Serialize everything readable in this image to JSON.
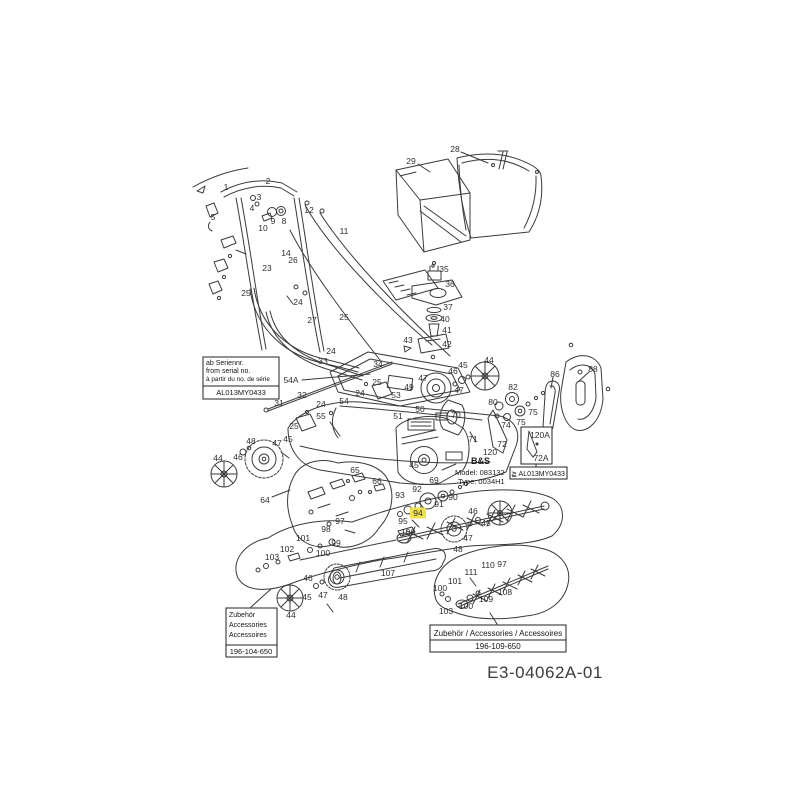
{
  "colors": {
    "background": "#ffffff",
    "line": "#3a3a3a",
    "highlight": "#efe24e",
    "label_text": "#2e2e2e"
  },
  "doc_code": "E3-04062A-01",
  "engine_plate": {
    "brand": "B&S",
    "model": "Model: 083132",
    "type": "Type: 0034H1"
  },
  "boxes": {
    "serial": {
      "line1": "ab Seriennr.",
      "line2": "from serial no.",
      "line3": "à partir du no. de série",
      "code": "AL013MY0433"
    },
    "variant": {
      "code": "≧ AL013MY0433"
    },
    "accessories_left": {
      "line1": "Zubehör",
      "line2": "Accessories",
      "line3": "Accessoires",
      "code": "196-104-650"
    },
    "accessories_right": {
      "title": "Zubehör / Accessories / Accessoires",
      "code": "196-109-650"
    }
  },
  "diagram": {
    "labels": [
      {
        "t": "1",
        "x": 226,
        "y": 187
      },
      {
        "t": "2",
        "x": 268,
        "y": 181
      },
      {
        "t": "3",
        "x": 259,
        "y": 197
      },
      {
        "t": "4",
        "x": 252,
        "y": 208
      },
      {
        "t": "5",
        "x": 213,
        "y": 217
      },
      {
        "t": "9",
        "x": 273,
        "y": 221
      },
      {
        "t": "8",
        "x": 284,
        "y": 221
      },
      {
        "t": "10",
        "x": 263,
        "y": 228
      },
      {
        "t": "12",
        "x": 309,
        "y": 210
      },
      {
        "t": "11",
        "x": 344,
        "y": 231
      },
      {
        "t": "14",
        "x": 286,
        "y": 253
      },
      {
        "t": "26",
        "x": 293,
        "y": 260
      },
      {
        "t": "23",
        "x": 267,
        "y": 268
      },
      {
        "t": "25",
        "x": 246,
        "y": 293
      },
      {
        "t": "24",
        "x": 298,
        "y": 302
      },
      {
        "t": "27",
        "x": 312,
        "y": 320
      },
      {
        "t": "25",
        "x": 344,
        "y": 317
      },
      {
        "t": "29",
        "x": 411,
        "y": 161
      },
      {
        "t": "28",
        "x": 455,
        "y": 149
      },
      {
        "t": "35",
        "x": 444,
        "y": 269
      },
      {
        "t": "36",
        "x": 450,
        "y": 284
      },
      {
        "t": "37",
        "x": 448,
        "y": 307
      },
      {
        "t": "40",
        "x": 445,
        "y": 319
      },
      {
        "t": "41",
        "x": 447,
        "y": 330
      },
      {
        "t": "42",
        "x": 447,
        "y": 344
      },
      {
        "t": "43",
        "x": 408,
        "y": 340
      },
      {
        "t": "24",
        "x": 331,
        "y": 351
      },
      {
        "t": "33",
        "x": 323,
        "y": 361
      },
      {
        "t": "34",
        "x": 378,
        "y": 364
      },
      {
        "t": "54A",
        "x": 291,
        "y": 380
      },
      {
        "t": "25",
        "x": 377,
        "y": 382
      },
      {
        "t": "32",
        "x": 302,
        "y": 395
      },
      {
        "t": "24",
        "x": 360,
        "y": 393
      },
      {
        "t": "54",
        "x": 344,
        "y": 401
      },
      {
        "t": "31",
        "x": 279,
        "y": 403
      },
      {
        "t": "24",
        "x": 321,
        "y": 404
      },
      {
        "t": "55",
        "x": 321,
        "y": 416
      },
      {
        "t": "25",
        "x": 294,
        "y": 426
      },
      {
        "t": "48",
        "x": 251,
        "y": 441
      },
      {
        "t": "45",
        "x": 288,
        "y": 439
      },
      {
        "t": "47",
        "x": 277,
        "y": 443
      },
      {
        "t": "46",
        "x": 238,
        "y": 457
      },
      {
        "t": "44",
        "x": 218,
        "y": 458
      },
      {
        "t": "44",
        "x": 489,
        "y": 360
      },
      {
        "t": "45",
        "x": 463,
        "y": 365
      },
      {
        "t": "46",
        "x": 453,
        "y": 371
      },
      {
        "t": "47",
        "x": 423,
        "y": 378
      },
      {
        "t": "47",
        "x": 459,
        "y": 390
      },
      {
        "t": "49",
        "x": 409,
        "y": 387
      },
      {
        "t": "53",
        "x": 396,
        "y": 395
      },
      {
        "t": "50",
        "x": 420,
        "y": 409
      },
      {
        "t": "51",
        "x": 398,
        "y": 416
      },
      {
        "t": "86",
        "x": 555,
        "y": 374
      },
      {
        "t": "88",
        "x": 593,
        "y": 369
      },
      {
        "t": "82",
        "x": 513,
        "y": 387
      },
      {
        "t": "80",
        "x": 493,
        "y": 402
      },
      {
        "t": "75",
        "x": 533,
        "y": 412
      },
      {
        "t": "75",
        "x": 521,
        "y": 422
      },
      {
        "t": "74",
        "x": 506,
        "y": 425
      },
      {
        "t": "70",
        "x": 456,
        "y": 415
      },
      {
        "t": "71",
        "x": 473,
        "y": 439
      },
      {
        "t": "72",
        "x": 502,
        "y": 444
      },
      {
        "t": "120",
        "x": 490,
        "y": 452
      },
      {
        "t": "120A",
        "x": 540,
        "y": 435
      },
      {
        "t": "72A",
        "x": 541,
        "y": 458
      },
      {
        "t": "45",
        "x": 414,
        "y": 465
      },
      {
        "t": "69",
        "x": 434,
        "y": 480
      },
      {
        "t": "92",
        "x": 417,
        "y": 489
      },
      {
        "t": "93",
        "x": 400,
        "y": 495
      },
      {
        "t": "90",
        "x": 453,
        "y": 497
      },
      {
        "t": "91",
        "x": 439,
        "y": 504
      },
      {
        "t": "94",
        "x": 418,
        "y": 513,
        "hl": true
      },
      {
        "t": "95",
        "x": 403,
        "y": 521
      },
      {
        "t": "106",
        "x": 408,
        "y": 532
      },
      {
        "t": "46",
        "x": 473,
        "y": 511
      },
      {
        "t": "45",
        "x": 486,
        "y": 523
      },
      {
        "t": "47",
        "x": 468,
        "y": 538
      },
      {
        "t": "48",
        "x": 458,
        "y": 549
      },
      {
        "t": "65",
        "x": 355,
        "y": 470
      },
      {
        "t": "66",
        "x": 377,
        "y": 481
      },
      {
        "t": "64",
        "x": 265,
        "y": 500
      },
      {
        "t": "97",
        "x": 340,
        "y": 521
      },
      {
        "t": "98",
        "x": 326,
        "y": 529
      },
      {
        "t": "99",
        "x": 336,
        "y": 543
      },
      {
        "t": "101",
        "x": 303,
        "y": 538
      },
      {
        "t": "102",
        "x": 287,
        "y": 549
      },
      {
        "t": "100",
        "x": 323,
        "y": 553
      },
      {
        "t": "103",
        "x": 272,
        "y": 557
      },
      {
        "t": "107",
        "x": 388,
        "y": 573
      },
      {
        "t": "46",
        "x": 308,
        "y": 578
      },
      {
        "t": "45",
        "x": 307,
        "y": 597
      },
      {
        "t": "47",
        "x": 323,
        "y": 595
      },
      {
        "t": "48",
        "x": 343,
        "y": 597
      },
      {
        "t": "44",
        "x": 291,
        "y": 615
      },
      {
        "t": "110",
        "x": 488,
        "y": 565
      },
      {
        "t": "97",
        "x": 502,
        "y": 564
      },
      {
        "t": "111",
        "x": 471,
        "y": 572
      },
      {
        "t": "101",
        "x": 455,
        "y": 581
      },
      {
        "t": "100",
        "x": 440,
        "y": 588
      },
      {
        "t": "108",
        "x": 505,
        "y": 592
      },
      {
        "t": "109",
        "x": 486,
        "y": 599
      },
      {
        "t": "100",
        "x": 466,
        "y": 606
      },
      {
        "t": "103",
        "x": 446,
        "y": 611
      }
    ]
  }
}
